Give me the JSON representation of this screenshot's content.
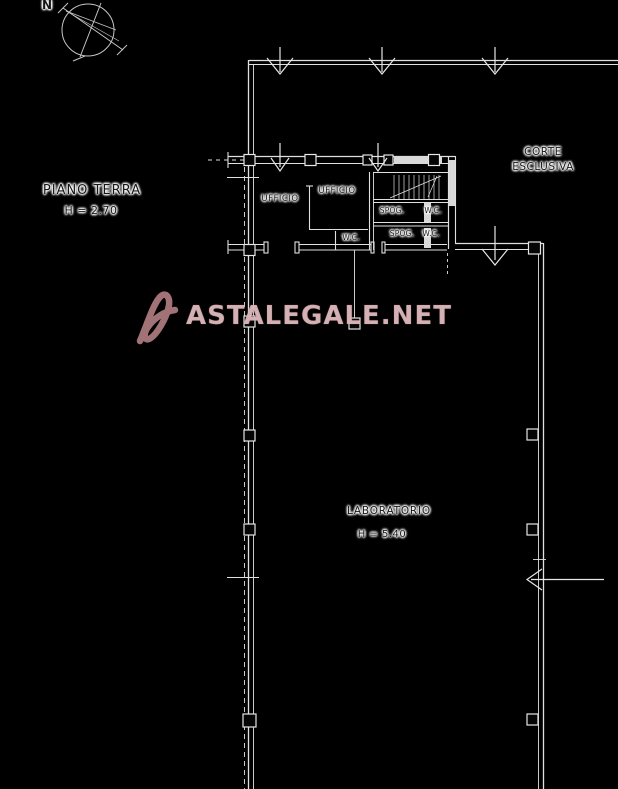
{
  "plan": {
    "title": "PIANO TERRA",
    "title_height": "H = 2.70",
    "compass_north": "N",
    "court_line1": "CORTE",
    "court_line2": "ESCLUSIVA",
    "rooms": {
      "ufficio_left": {
        "label": "UFFICIO"
      },
      "ufficio_center": {
        "label": "UFFICIO"
      },
      "spog_top": {
        "label": "SPOG."
      },
      "wc_top": {
        "label": "W.C."
      },
      "spog_bottom": {
        "label": "SPOG."
      },
      "wc_bottom": {
        "label": "W.C."
      },
      "wc_center": {
        "label": "W.C."
      },
      "laboratorio": {
        "label": "LABORATORIO",
        "height_label": "H = 5.40"
      }
    }
  },
  "watermark": {
    "text": "ASTALEGALE.NET",
    "logo": "astalegale-logo"
  },
  "colors": {
    "background": "#000000",
    "line": "#e0e0e0",
    "label_text": "#161616",
    "label_halo": "#ffffff",
    "watermark_text": "#e7cbcd",
    "watermark_logo": "#c98f94"
  }
}
